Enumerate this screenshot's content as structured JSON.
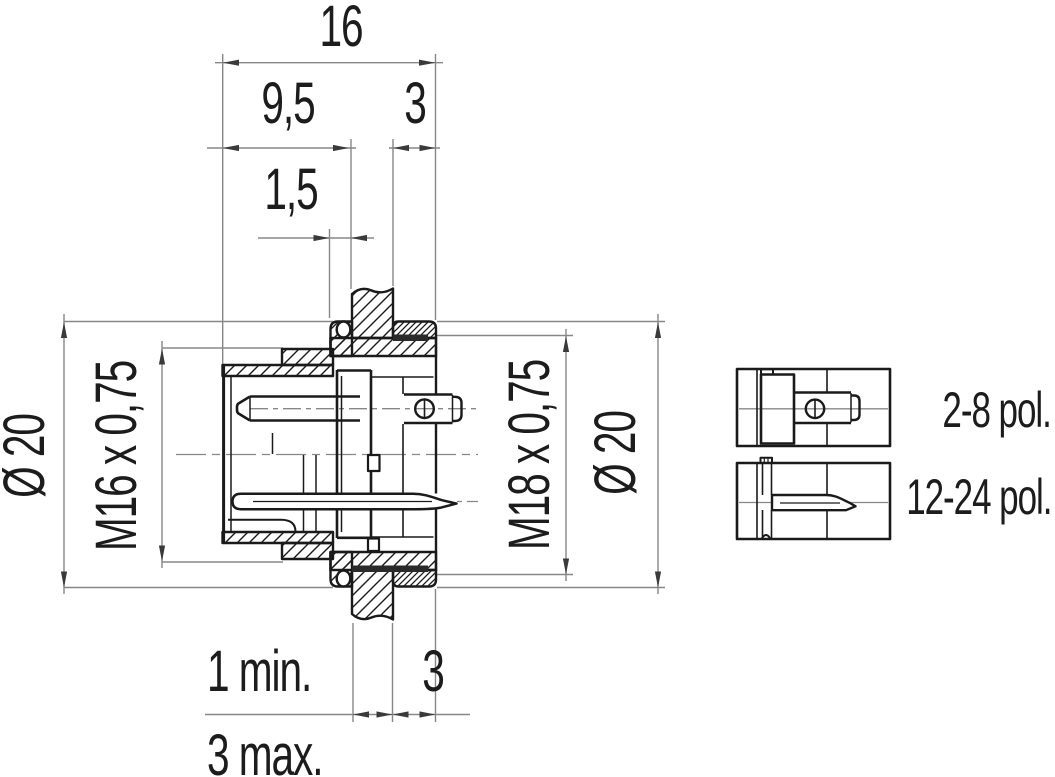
{
  "drawing": {
    "top_dimensions": {
      "overall_length": "16",
      "front_length": "9,5",
      "rear_length": "3",
      "flange_lip": "1,5"
    },
    "left_dimensions": {
      "flange_diameter": "Ø 20",
      "front_thread": "M16 x 0,75"
    },
    "right_dimensions": {
      "rear_thread": "M18 x 0,75",
      "flange_diameter": "Ø 20"
    },
    "bottom_dimensions": {
      "panel_thickness_min": "1 min.",
      "rear_offset": "3",
      "panel_thickness_max": "3 max."
    },
    "variants": [
      {
        "label": "2-8 pol."
      },
      {
        "label": "12-24 pol."
      }
    ],
    "colors": {
      "line": "#1a1a1a",
      "dimension": "#878787",
      "background": "#ffffff"
    }
  }
}
